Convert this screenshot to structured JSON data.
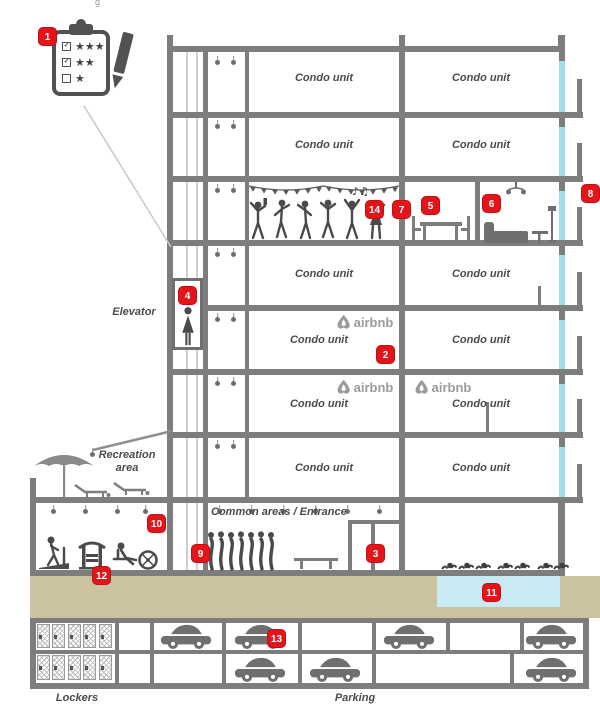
{
  "colors": {
    "accent_red": "#e2151b",
    "structure_gray": "#7d7d7d",
    "ground_tan": "#cbc3a0",
    "pool_blue": "#c9eaf3",
    "window_cyan": "#a6dbeb",
    "icon_gray": "#4a4a4a",
    "airbnb_gray": "#9b9b9b"
  },
  "labels": {
    "condo_unit": "Condo unit",
    "elevator": "Elevator",
    "recreation_line1": "Recreation",
    "recreation_line2": "area",
    "common_areas": "Common areas / Entrance",
    "lockers": "Lockers",
    "parking": "Parking",
    "airbnb": "airbnb",
    "party_notes": "♪♫",
    "artifact": "g"
  },
  "markers": {
    "m1": "1",
    "m2": "2",
    "m3": "3",
    "m4": "4",
    "m5": "5",
    "m6": "6",
    "m7": "7",
    "m8": "8",
    "m9": "9",
    "m10": "10",
    "m11": "11",
    "m12": "12",
    "m13": "13",
    "m14": "14"
  },
  "clipboard": {
    "rows": [
      {
        "check": "✓",
        "stars": "★★★"
      },
      {
        "check": "✓",
        "stars": "★★"
      },
      {
        "check": "",
        "stars": "★"
      }
    ]
  }
}
